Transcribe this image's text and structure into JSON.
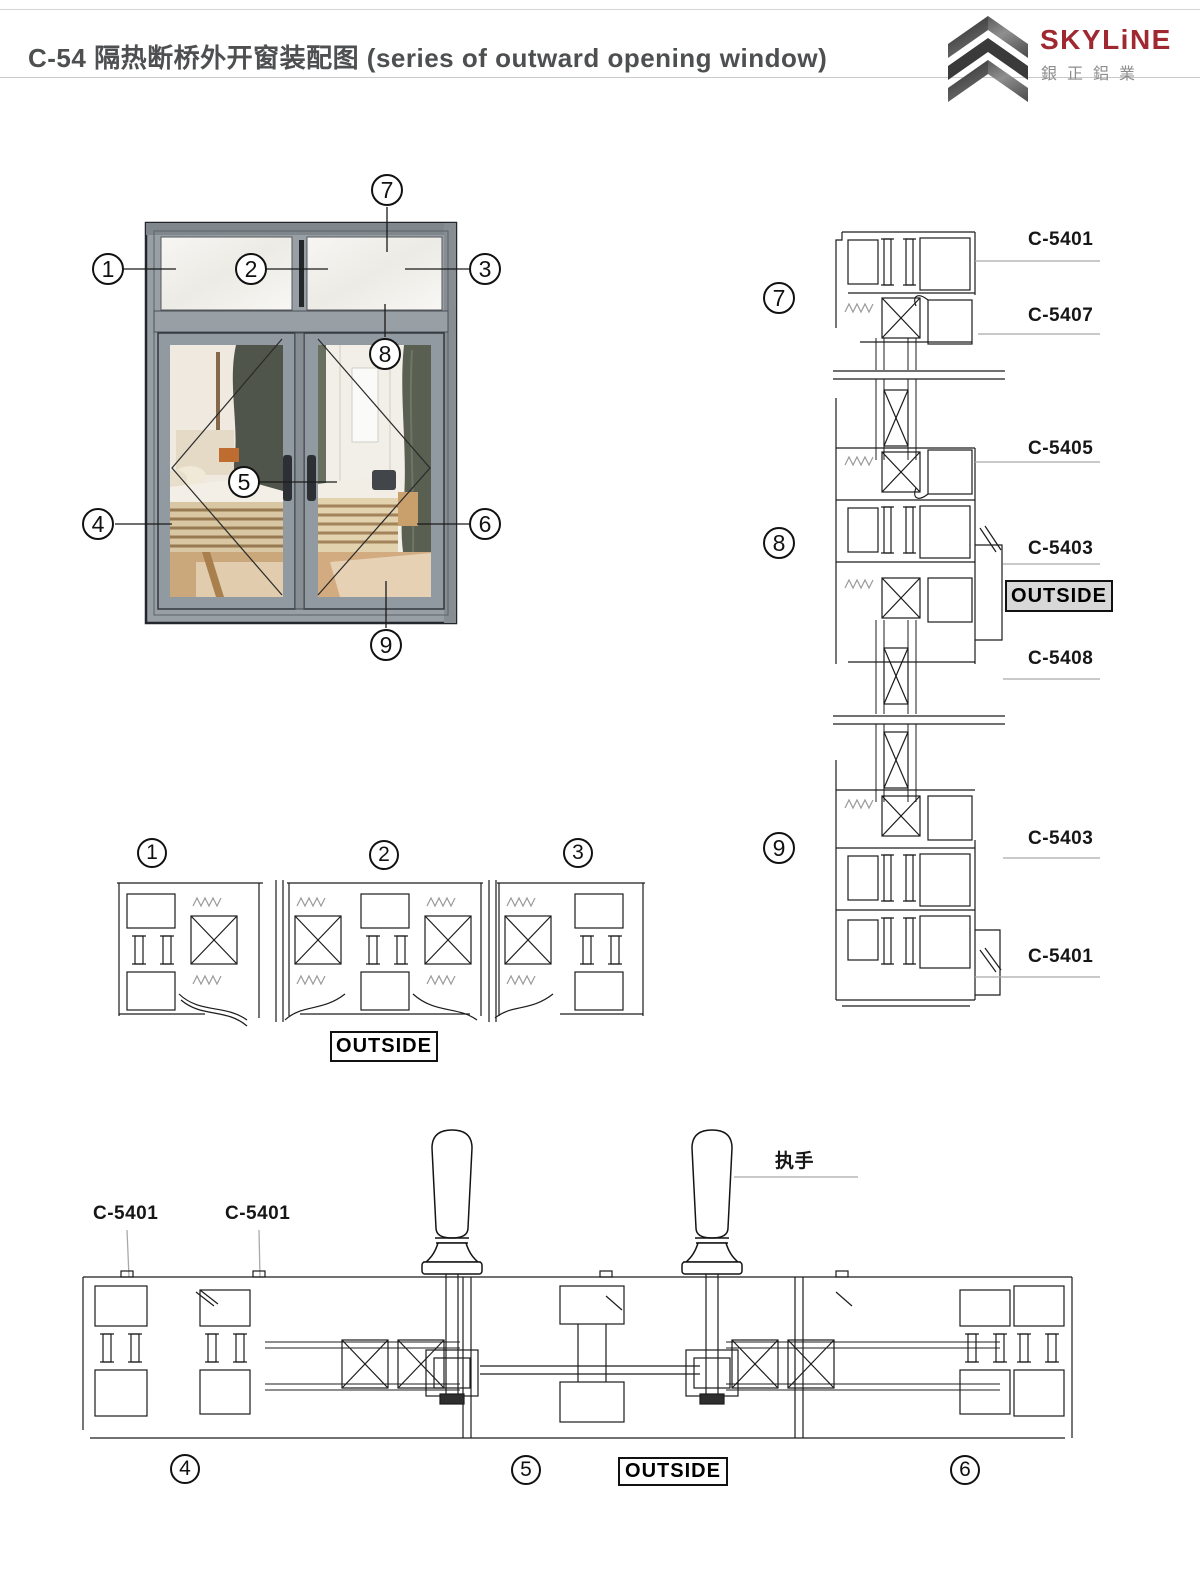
{
  "header": {
    "title": "C-54 隔热断桥外开窗装配图 (series of outward opening window)",
    "logo": {
      "brand": "SKYLiNE",
      "brand_cn": "銀正鋁業"
    }
  },
  "window_diagram": {
    "callouts": [
      "1",
      "2",
      "3",
      "4",
      "5",
      "6",
      "7",
      "8",
      "9"
    ]
  },
  "middle_detail": {
    "callouts": [
      "1",
      "2",
      "3"
    ],
    "outside_label": "OUTSIDE"
  },
  "right_detail": {
    "callouts": [
      "7",
      "8",
      "9"
    ],
    "part_labels": [
      "C-5401",
      "C-5407",
      "C-5405",
      "C-5403",
      "C-5408",
      "C-5403",
      "C-5401"
    ],
    "outside_label": "OUTSIDE"
  },
  "bottom_detail": {
    "callouts": [
      "4",
      "5",
      "6"
    ],
    "part_labels": [
      "C-5401",
      "C-5401"
    ],
    "handle_label": "执手",
    "outside_label": "OUTSIDE"
  },
  "colors": {
    "brand_red": "#a02830",
    "frame_gray": "#98a0a6",
    "line": "#1c1c1c"
  }
}
